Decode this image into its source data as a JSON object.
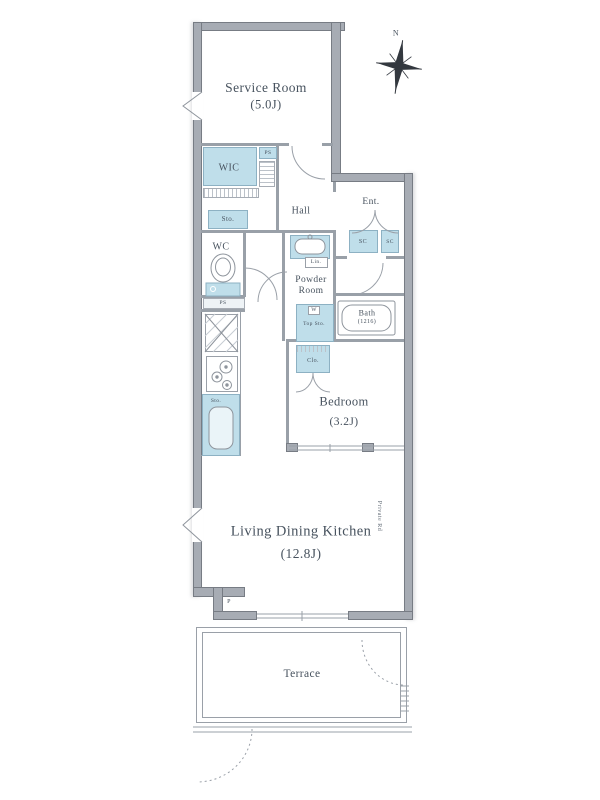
{
  "compass": {
    "north": "N"
  },
  "rooms": {
    "service_room_name": "Service Room",
    "service_room_size": "(5.0J)",
    "wic": "WIC",
    "hall": "Hall",
    "entrance": "Ent.",
    "wc": "WC",
    "powder_line1": "Powder",
    "powder_line2": "Room",
    "bath_name": "Bath",
    "bath_size": "(1216)",
    "bedroom_name": "Bedroom",
    "bedroom_size": "(3.2J)",
    "ldk_name": "Living Dining Kitchen",
    "ldk_size": "(12.8J)",
    "terrace": "Terrace"
  },
  "storage": {
    "ps_upper": "PS",
    "ps_lower": "PS",
    "sto": "Sto.",
    "sc_left": "SC",
    "sc_right": "SC",
    "linen": "Lin.",
    "washer": "W",
    "top_sto": "Top Sto.",
    "closet": "Clo.",
    "kitchen_sto": "Sto.",
    "pillar": "P"
  },
  "annotations": {
    "private_road": "Private Rd"
  },
  "colors": {
    "wall": "#a7acb4",
    "wall_edge": "#777c84",
    "partition": "#99a0a8",
    "fixture_fill": "#bfdeea",
    "fixture_border": "#8db1c3",
    "text": "#47525e"
  }
}
